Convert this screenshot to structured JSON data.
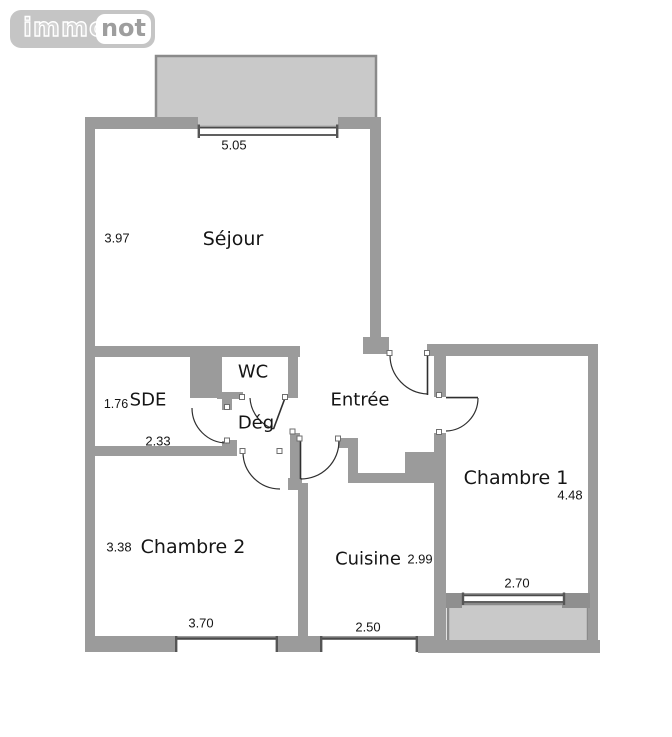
{
  "logo": {
    "brand_part1": "immo",
    "brand_part2": "not"
  },
  "floorplan": {
    "labels": {
      "sejour": "Séjour",
      "wc": "WC",
      "sde": "SDE",
      "deg": "Dég",
      "entree": "Entrée",
      "chambre1": "Chambre 1",
      "chambre2": "Chambre 2",
      "cuisine": "Cuisine"
    },
    "dims": {
      "sejour_width": "5.05",
      "sejour_height": "3.97",
      "sde_height": "1.76",
      "sde_width": "2.33",
      "chambre2_height": "3.38",
      "chambre2_width": "3.70",
      "cuisine_width": "2.50",
      "cuisine_depth": "2.99",
      "chambre1_window_width": "2.70",
      "chambre1_height": "4.48"
    },
    "colors": {
      "wall": "#9b9b9b",
      "balcony_fill": "#c9c9c9",
      "balcony_border": "#8a8a8a",
      "door_line": "#2f2f2f",
      "logo_bg": "#c5c5c5",
      "logo_text": "#9e9e9e"
    }
  }
}
